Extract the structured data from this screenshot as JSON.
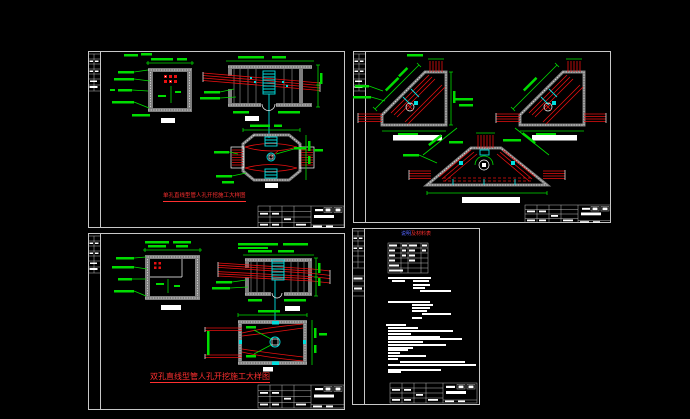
{
  "colors": {
    "bg": "#000000",
    "frame": "#c8c8c8",
    "green": "#00dd00",
    "red": "#e81010",
    "cyan": "#00e0e0",
    "gray_wall": "#7d7d7d",
    "caption_red": "#ff3030",
    "note_blue": "#5566ff",
    "white": "#ffffff"
  },
  "sheets": [
    {
      "name": "sheet-single-hole-straight-manhole",
      "caption": "单孔直线型管人孔开挖施工大样图"
    },
    {
      "name": "sheet-corner-manholes"
    },
    {
      "name": "sheet-double-hole-straight-manhole",
      "caption": "双孔直线型管人孔开挖施工大样图"
    },
    {
      "name": "sheet-notes",
      "header_blue": "说明",
      "header_red": "及材料表",
      "notes_bars": [
        [
          36,
          49,
          43
        ],
        [
          40,
          52,
          13
        ],
        [
          61,
          52,
          16
        ],
        [
          61,
          56,
          17
        ],
        [
          61,
          59,
          12
        ],
        [
          68,
          62,
          31
        ],
        [
          36,
          73,
          42
        ],
        [
          60,
          76,
          21
        ],
        [
          60,
          79,
          18
        ],
        [
          60,
          82,
          15
        ],
        [
          70,
          85,
          29
        ],
        [
          60,
          89,
          10
        ],
        [
          34,
          96,
          20
        ],
        [
          36,
          99,
          30
        ],
        [
          36,
          102,
          65
        ],
        [
          36,
          105,
          23
        ],
        [
          36,
          108,
          52
        ],
        [
          36,
          110,
          74
        ],
        [
          36,
          113,
          35
        ],
        [
          36,
          116,
          58
        ],
        [
          36,
          119,
          25
        ],
        [
          36,
          121,
          20
        ],
        [
          36,
          124,
          12
        ],
        [
          36,
          127,
          38
        ],
        [
          36,
          130,
          10
        ],
        [
          48,
          133,
          65
        ],
        [
          36,
          136,
          88
        ],
        [
          36,
          141,
          53
        ],
        [
          36,
          143,
          13
        ]
      ]
    }
  ]
}
